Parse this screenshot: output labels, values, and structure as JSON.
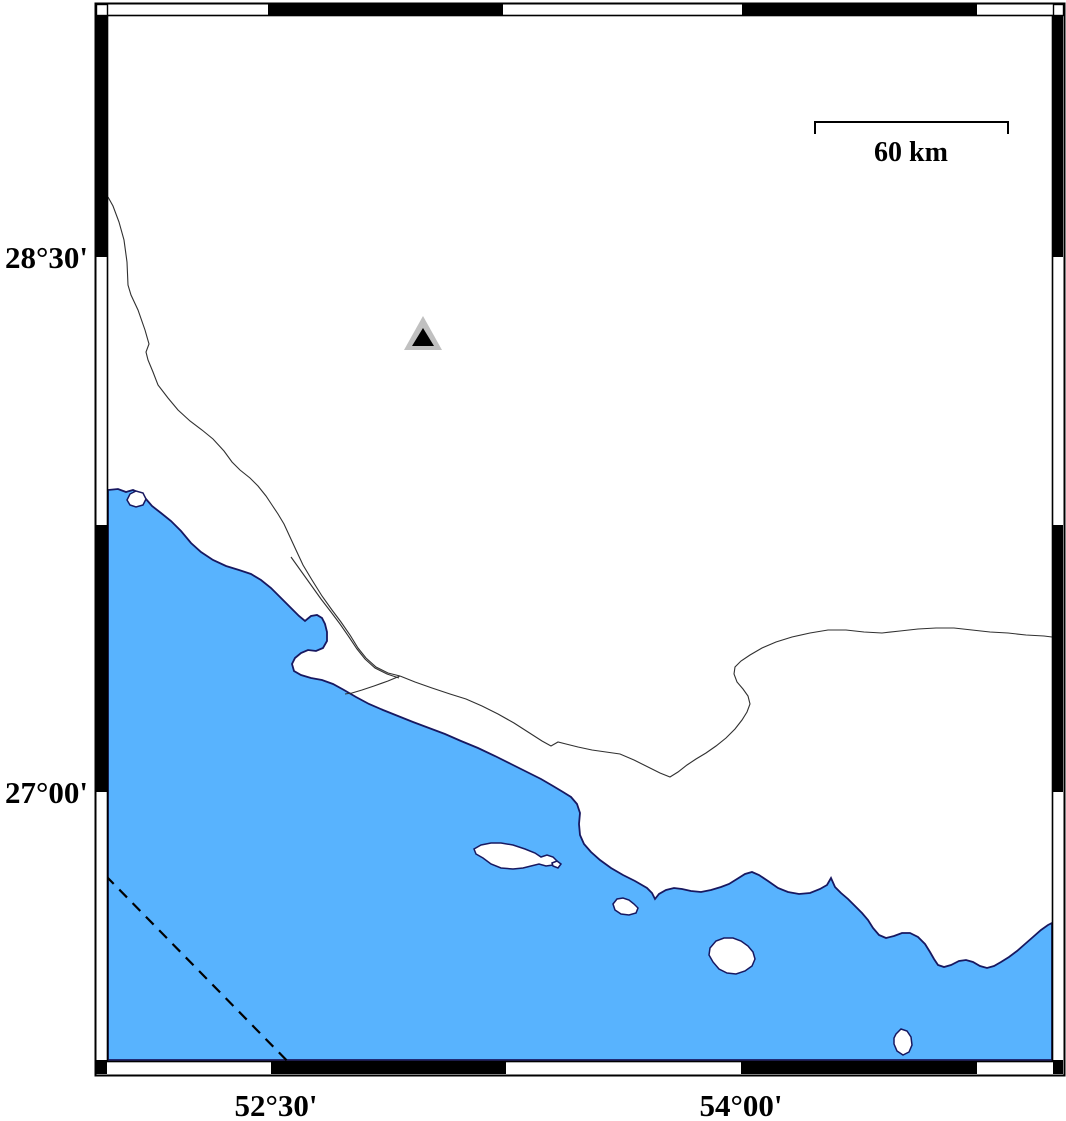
{
  "map": {
    "colors": {
      "background": "#ffffff",
      "sea": "#58b3fe",
      "coastline": "#181860",
      "land": "#ffffff",
      "river": "#303030",
      "frame": "#000000",
      "boundary": "#000000",
      "marker_outer": "#c0c0c0",
      "marker_inner": "#000000"
    },
    "axis_labels": {
      "left": [
        {
          "text": "28°30'",
          "x": 88,
          "y": 268
        },
        {
          "text": "27°00'",
          "x": 88,
          "y": 803
        }
      ],
      "bottom": [
        {
          "text": "52°30'",
          "x": 276,
          "y": 1116
        },
        {
          "text": "54°00'",
          "x": 741,
          "y": 1116
        }
      ]
    },
    "scale_bar": {
      "label": "60 km",
      "path": "M815,134 L815,122 L1008,122 L1008,134",
      "label_x": 911,
      "label_y": 161
    },
    "station_marker": {
      "shape": "triangle",
      "outer_points": "423,316 404,350 442,350",
      "inner_points": "423,328 412,346 434,346"
    },
    "frame": {
      "outer_rect": {
        "x": 95,
        "y": 3,
        "w": 969,
        "h": 1072
      },
      "inner_rect": {
        "x": 107,
        "y": 15,
        "w": 945,
        "h": 1046
      },
      "black_segments": [
        {
          "x": 268,
          "y": 4,
          "w": 235,
          "h": 12
        },
        {
          "x": 742,
          "y": 4,
          "w": 235,
          "h": 12
        },
        {
          "x": 271,
          "y": 1061,
          "w": 235,
          "h": 13
        },
        {
          "x": 741,
          "y": 1061,
          "w": 236,
          "h": 13
        },
        {
          "x": 96,
          "y": 16,
          "w": 11,
          "h": 241
        },
        {
          "x": 96,
          "y": 525,
          "w": 11,
          "h": 267
        },
        {
          "x": 96,
          "y": 1060,
          "w": 11,
          "h": 14
        },
        {
          "x": 1053,
          "y": 16,
          "w": 10,
          "h": 241
        },
        {
          "x": 1053,
          "y": 525,
          "w": 10,
          "h": 267
        },
        {
          "x": 1053,
          "y": 1060,
          "w": 10,
          "h": 14
        }
      ],
      "corner_squares": [
        {
          "x": 96,
          "y": 4,
          "w": 11,
          "h": 11,
          "fill": "#ffffff"
        },
        {
          "x": 1053,
          "y": 4,
          "w": 10,
          "h": 11,
          "fill": "#ffffff"
        }
      ]
    },
    "features": {
      "sea_path": "M108,490 L118,489 L126,492 L133,490 L140,493 L146,499 L152,506 L161,513 L171,521 L181,531 L191,543 L201,552 L213,560 L226,566 L239,570 L251,574 L261,580 L271,588 L281,598 L291,608 L299,616 L305,621 L311,616 L317,615 L322,618 L325,624 L327,632 L327,641 L323,648 L316,651 L308,650 L301,653 L295,658 L292,664 L294,671 L301,675 L311,678 L322,680 L333,684 L344,690 L356,697 L369,704 L383,710 L398,716 L413,722 L429,728 L445,734 L461,741 L478,748 L495,756 L511,764 L527,772 L541,779 L553,786 L563,792 L571,797 L577,804 L580,813 L579,824 L580,835 L584,844 L591,852 L600,860 L611,868 L623,875 L635,881 L647,888 L652,893 L655,899 L659,894 L666,890 L674,888 L682,889 L691,891 L701,892 L711,890 L721,887 L729,884 L737,879 L745,874 L752,872 L759,875 L768,881 L778,888 L788,892 L799,894 L810,893 L820,889 L827,885 L831,878 L835,887 L841,893 L848,899 L855,906 L862,913 L868,920 L873,928 L879,935 L886,938 L894,936 L902,933 L910,933 L918,937 L925,944 L930,952 L934,959 L938,965 L944,967 L951,965 L959,961 L966,960 L973,962 L980,966 L987,968 L994,966 L1001,962 L1009,957 L1017,951 L1025,944 L1033,937 L1041,930 L1048,925 L1052,923 L1052,1060 L108,1060 Z",
      "islands": [
        {
          "name": "island-large",
          "d": "M474,849 L481,845 L491,843 L501,843 L513,845 L525,849 L535,853 L541,857 L547,855 L553,857 L557,861 L553,865 L546,866 L539,864 L531,866 L523,868 L513,869 L501,868 L491,864 L483,858 L476,854 Z"
        },
        {
          "name": "islet-tiny",
          "d": "M552,863 L557,861 L561,864 L558,868 L553,866 Z"
        },
        {
          "name": "island-small",
          "d": "M613,904 L617,899 L623,898 L629,900 L634,904 L638,908 L636,913 L629,915 L621,914 L615,910 Z"
        },
        {
          "name": "island-medium",
          "d": "M710,948 L716,941 L724,938 L733,938 L741,941 L748,946 L753,952 L755,959 L752,966 L745,971 L736,974 L727,973 L719,969 L713,962 L709,955 Z"
        },
        {
          "name": "island-bottom",
          "d": "M896,1034 L901,1029 L907,1031 L911,1037 L912,1045 L909,1052 L903,1055 L897,1051 L894,1044 L894,1038 Z"
        },
        {
          "name": "coastal-islet",
          "d": "M127,500 L130,494 L136,491 L143,493 L146,499 L143,505 L136,507 L130,505 Z"
        }
      ],
      "rivers": [
        {
          "name": "river-northwest",
          "d": "M108,197 L113,206 L119,222 L124,240 L127,262 L128,285 L131,295 L138,310 L145,330 L149,344 L146,352 L148,360 L153,372 L158,385 L168,398 L178,410 L190,421 L202,430 L213,439 L224,451 L232,462 L240,470 L250,478 L258,486 L266,496 L272,505 L278,514 L284,524 L290,537 L296,550 L303,565 L312,580 L322,596 L332,610 L341,622 L350,635 L358,648 L366,658 L376,667 L388,673 L400,676"
        },
        {
          "name": "river-northwest-parallel",
          "d": "M291,557 L301,571 L311,585 L321,599 L331,612 L340,624 L349,637 L357,649 L365,659 L375,668 L387,674 L399,678"
        },
        {
          "name": "river-branch-to-coast",
          "d": "M400,676 L388,681 L374,686 L362,690 L352,693 L345,694"
        },
        {
          "name": "river-east",
          "d": "M400,676 L415,682 L432,688 L450,694 L466,699 L482,706 L498,714 L514,723 L528,732 L542,741 L551,746 L558,742 L566,744 L578,747 L592,750 L606,752 L620,754 L634,760 L648,767 L660,773 L670,777 L678,772 L687,765 L696,759 L706,753 L716,746 L726,738 L735,729 L742,720 L747,712 L750,704 L748,696 L743,689 L737,682 L734,674 L735,667 L741,661 L750,655 L762,648 L776,642 L792,637 L810,633 L828,630 L846,630 L864,632 L882,633 L900,631 L918,629 L936,628 L954,628 L972,630 L990,632 L1008,633 L1026,635 L1044,636 L1052,637"
        }
      ],
      "dashed_boundary": "M106,876 L302,1076"
    }
  }
}
